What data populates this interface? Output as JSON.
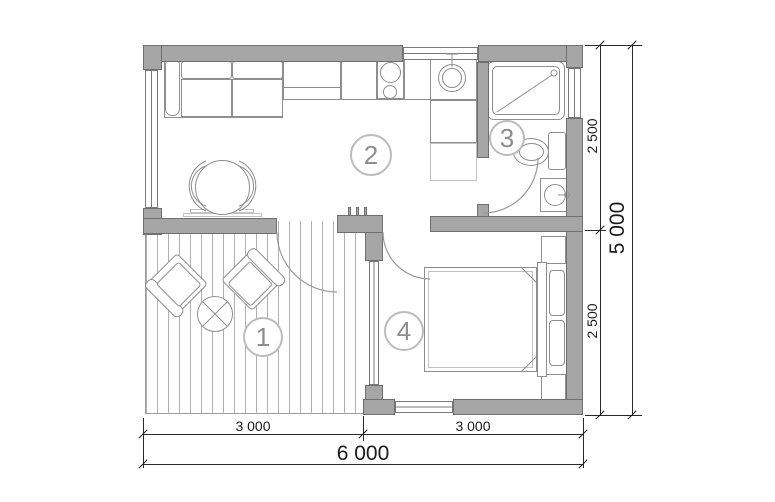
{
  "rooms": {
    "labels": [
      "1",
      "2",
      "3",
      "4"
    ]
  },
  "dimensions": {
    "bottom_segments": [
      "3 000",
      "3 000"
    ],
    "bottom_total": "6 000",
    "right_segments": [
      "2 500",
      "2 500"
    ],
    "right_total": "5 000"
  },
  "colors": {
    "wall_fill": "#a6a6a6",
    "wall_outline": "#6f6f6f",
    "furniture_stroke": "#8e8e8e",
    "dimension_ink": "#1b1b1b",
    "room_label": "#8d8d8d",
    "deck_stripe": "#b0b0b0",
    "background": "#ffffff"
  }
}
